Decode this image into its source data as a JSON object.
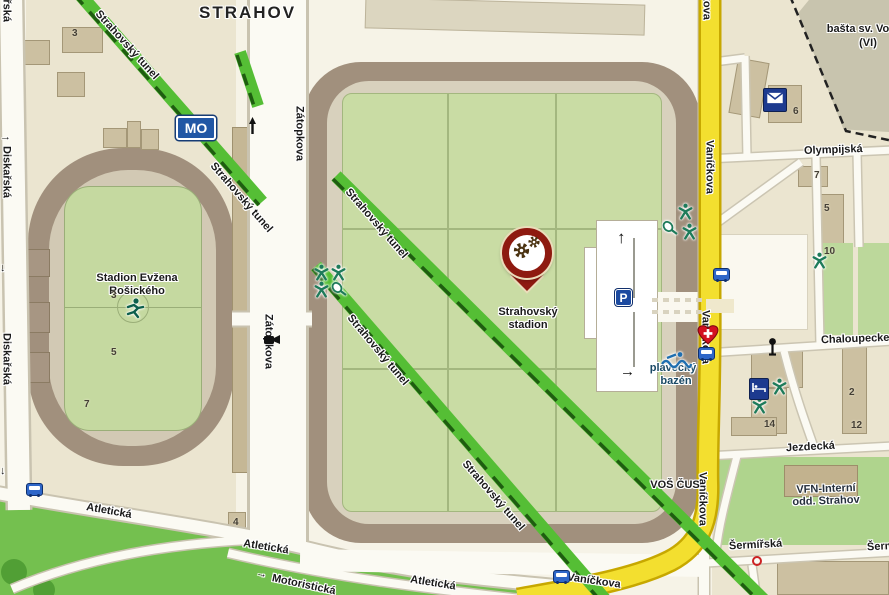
{
  "region_title": "STRAHOV",
  "streets": {
    "diskarska": "Diskařská",
    "zatopkova": "Zátopkova",
    "tunel": "Strahovský tunel",
    "atleticka": "Atletická",
    "motoristicka": "Motoristická",
    "vanickova": "Vaníčkova",
    "olympijska": "Olympijská",
    "chaloupeckeho": "Chaloupecke",
    "jezdecka": "Jezdecká",
    "sermirska": "Šermířská"
  },
  "places": {
    "stadion_evzena_line1": "Stadion Evžena",
    "stadion_evzena_line2": "Rošického",
    "strahovsky_stadion_line1": "Strahovský",
    "strahovsky_stadion_line2": "stadion",
    "vos_cus": "VOŠ ČUS",
    "plavecky_line1": "plavecký",
    "plavecky_line2": "bazén",
    "vfn_line1": "VFN-Interní",
    "vfn_line2": "odd. Strahov",
    "basta_line1": "bašta sv. Vo",
    "basta_line2": "(VI)"
  },
  "signs": {
    "ring_road": "MO",
    "parking": "P"
  },
  "arrows": {
    "up": "↑",
    "right": "→",
    "down": "↓"
  },
  "building_numbers": [
    {
      "n": "3",
      "x": 72,
      "y": 28
    },
    {
      "n": "3",
      "x": 111,
      "y": 290
    },
    {
      "n": "5",
      "x": 111,
      "y": 347
    },
    {
      "n": "7",
      "x": 84,
      "y": 399
    },
    {
      "n": "4",
      "x": 233,
      "y": 517
    },
    {
      "n": "6",
      "x": 793,
      "y": 106
    },
    {
      "n": "7",
      "x": 814,
      "y": 170
    },
    {
      "n": "5",
      "x": 824,
      "y": 203
    },
    {
      "n": "10",
      "x": 824,
      "y": 246
    },
    {
      "n": "1",
      "x": 758,
      "y": 389
    },
    {
      "n": "2",
      "x": 849,
      "y": 387
    },
    {
      "n": "14",
      "x": 764,
      "y": 419
    },
    {
      "n": "12",
      "x": 851,
      "y": 420
    }
  ],
  "icon_legend": {
    "pin": "poi-marker-with-gears",
    "bus": "bus-stop",
    "envelope": "post-office",
    "heart_cross": "medical-heart",
    "bed": "hotel",
    "gymnast": "sports-ground",
    "racket": "tennis-court",
    "runner": "athletics-stadium",
    "swimmer": "swimming-pool",
    "pole": "signpost",
    "camera": "camera",
    "monument": "monument",
    "crossing": "pedestrian-crossing",
    "red_ring": "poi-circle"
  },
  "colors": {
    "tunnel_green": "#55BE35",
    "tunnel_dash": "#1E5D10",
    "road_yellow": "#F3DF2F",
    "stands_brown": "#A1907D",
    "field_green": "#C9DCA4",
    "park_green": "#74C04F",
    "pin_red": "#8E1A10",
    "sign_blue": "#2157A5",
    "icon_navy": "#1D3A8F",
    "icon_teal": "#1E7B5A"
  }
}
